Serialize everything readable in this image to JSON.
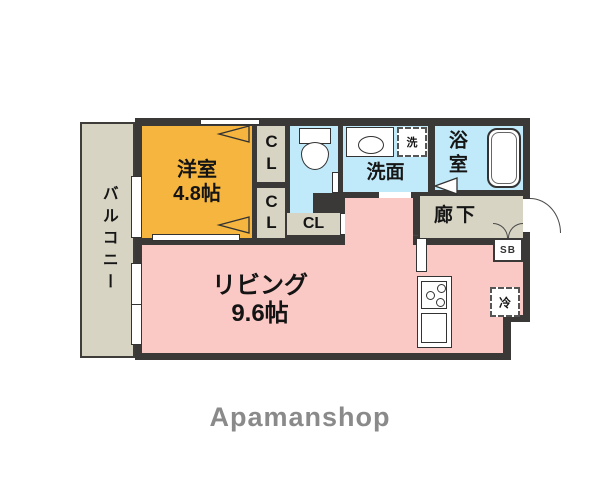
{
  "branding": {
    "logo_text": "Apamanshop"
  },
  "rooms": {
    "balcony": {
      "label": "バルコニー"
    },
    "western_room": {
      "label": "洋室",
      "size": "4.8帖"
    },
    "living": {
      "label": "リビング",
      "size": "9.6帖"
    },
    "toilet": {
      "label": ""
    },
    "washroom": {
      "label": "洗面"
    },
    "bathroom": {
      "label": "浴室"
    },
    "hallway": {
      "label": "廊下"
    },
    "closet_top": {
      "label": "CL"
    },
    "closet_bottom": {
      "label": "CL"
    },
    "closet_hall": {
      "label": "CL"
    }
  },
  "fixtures": {
    "washing_machine": {
      "label": "洗"
    },
    "refrigerator": {
      "label": "冷"
    },
    "shoe_box": {
      "label": "SB"
    }
  },
  "colors": {
    "wall": "#3b3937",
    "western_room": "#f5b53f",
    "living": "#fac9c5",
    "wet_area": "#c0eafa",
    "balcony_hall": "#d7d4c4",
    "logo_gray": "#8a8a8a"
  }
}
